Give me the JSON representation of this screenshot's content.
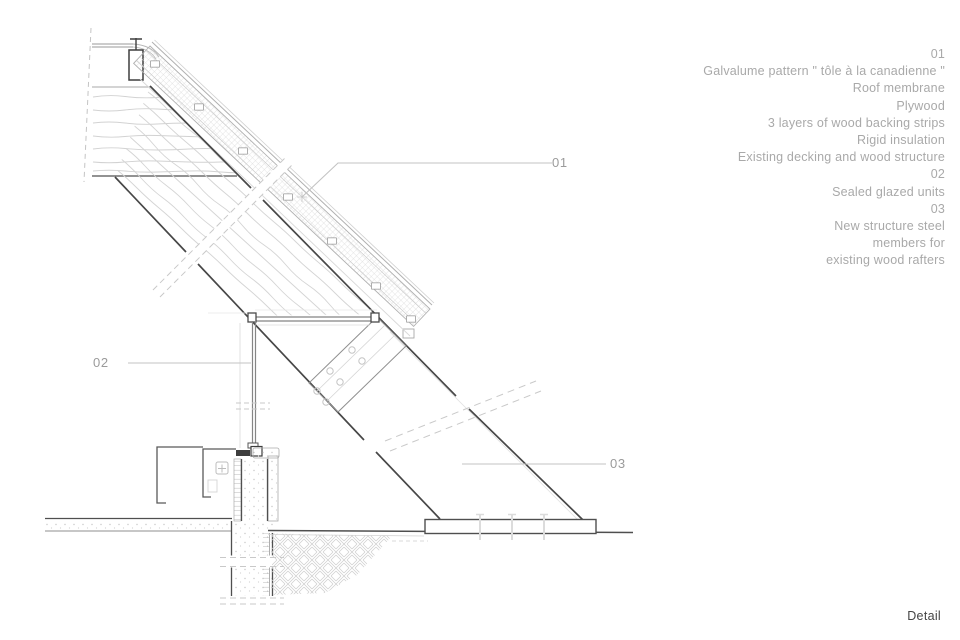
{
  "drawing": {
    "callouts": {
      "c1": "01",
      "c2": "02",
      "c3": "03"
    }
  },
  "legend": {
    "lines": [
      "01",
      "Galvalume pattern \" tôle à la canadienne \"",
      "Roof membrane",
      "Plywood",
      "3 layers of wood backing strips",
      "Rigid insulation",
      "Existing decking and wood structure",
      "02",
      "Sealed glazed units",
      "03",
      "New structure steel",
      "members for",
      "existing wood rafters"
    ]
  },
  "title": "Detail",
  "colors": {
    "line_dark": "#474747",
    "line_medium": "#858585",
    "line_light": "#c9c9c9",
    "text_muted": "#a9a9a9",
    "text_title": "#454545",
    "background": "#ffffff"
  }
}
